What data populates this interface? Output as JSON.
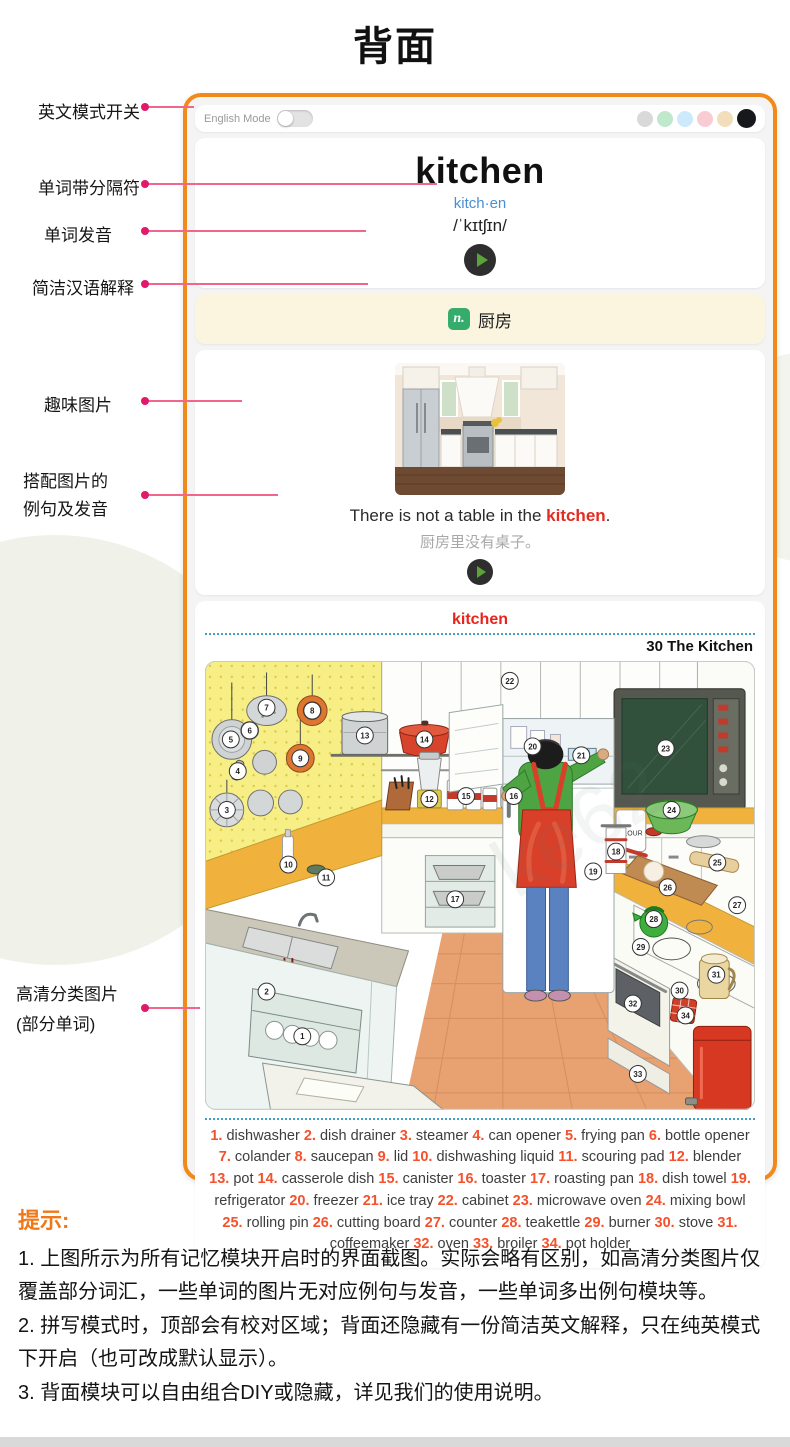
{
  "page": {
    "title": "背面"
  },
  "annotations": {
    "english_mode": "英文模式开关",
    "separator": "单词带分隔符",
    "pronunciation": "单词发音",
    "chinese_def": "简洁汉语解释",
    "fun_picture": "趣味图片",
    "example_l1": "搭配图片的",
    "example_l2": "例句及发音",
    "hd_l1": "高清分类图片",
    "hd_l2": "(部分单词)"
  },
  "card": {
    "topbar": {
      "english_mode_label": "English Mode",
      "theme_dots": [
        "#d9d9d9",
        "#bfe8cd",
        "#cdeafc",
        "#f9ccd4",
        "#f2debb",
        "#17181c"
      ]
    },
    "word": {
      "headword": "kitchen",
      "syllables": "kitch·en",
      "phonetic": "/ˈkɪtʃɪn/"
    },
    "definition": {
      "pos": "n.",
      "text": "厨房"
    },
    "example": {
      "sentence_prefix": "There is not a table in the ",
      "keyword": "kitchen",
      "suffix": ".",
      "translation": "厨房里没有桌子。"
    },
    "category": {
      "keyword": "kitchen",
      "lesson_title": "30 The Kitchen"
    }
  },
  "word_list": [
    {
      "n": "1.",
      "term": "dishwasher"
    },
    {
      "n": "2.",
      "term": "dish drainer"
    },
    {
      "n": "3.",
      "term": "steamer"
    },
    {
      "n": "4.",
      "term": "can opener"
    },
    {
      "n": "5.",
      "term": "frying pan"
    },
    {
      "n": "6.",
      "term": "bottle opener"
    },
    {
      "n": "7.",
      "term": "colander"
    },
    {
      "n": "8.",
      "term": "saucepan"
    },
    {
      "n": "9.",
      "term": "lid"
    },
    {
      "n": "10.",
      "term": "dishwashing liquid"
    },
    {
      "n": "11.",
      "term": "scouring pad"
    },
    {
      "n": "12.",
      "term": "blender"
    },
    {
      "n": "13.",
      "term": "pot"
    },
    {
      "n": "14.",
      "term": "casserole dish"
    },
    {
      "n": "15.",
      "term": "canister"
    },
    {
      "n": "16.",
      "term": "toaster"
    },
    {
      "n": "17.",
      "term": "roasting pan"
    },
    {
      "n": "18.",
      "term": "dish towel"
    },
    {
      "n": "19.",
      "term": "refrigerator"
    },
    {
      "n": "20.",
      "term": "freezer"
    },
    {
      "n": "21.",
      "term": "ice tray"
    },
    {
      "n": "22.",
      "term": "cabinet"
    },
    {
      "n": "23.",
      "term": "microwave oven"
    },
    {
      "n": "24.",
      "term": "mixing bowl"
    },
    {
      "n": "25.",
      "term": "rolling pin"
    },
    {
      "n": "26.",
      "term": "cutting board"
    },
    {
      "n": "27.",
      "term": "counter"
    },
    {
      "n": "28.",
      "term": "teakettle"
    },
    {
      "n": "29.",
      "term": "burner"
    },
    {
      "n": "30.",
      "term": "stove"
    },
    {
      "n": "31.",
      "term": "coffeemaker"
    },
    {
      "n": "32.",
      "term": "oven"
    },
    {
      "n": "33.",
      "term": "broiler"
    },
    {
      "n": "34.",
      "term": "pot holder"
    }
  ],
  "illustration": {
    "flour_label": "FLOUR",
    "watermark": "ke62",
    "badges": [
      {
        "n": "1",
        "x": 98,
        "y": 378
      },
      {
        "n": "2",
        "x": 62,
        "y": 333
      },
      {
        "n": "3",
        "x": 22,
        "y": 150
      },
      {
        "n": "4",
        "x": 33,
        "y": 111
      },
      {
        "n": "5",
        "x": 26,
        "y": 79
      },
      {
        "n": "6",
        "x": 45,
        "y": 70
      },
      {
        "n": "7",
        "x": 62,
        "y": 47
      },
      {
        "n": "8",
        "x": 108,
        "y": 50
      },
      {
        "n": "9",
        "x": 96,
        "y": 98
      },
      {
        "n": "10",
        "x": 84,
        "y": 205
      },
      {
        "n": "11",
        "x": 122,
        "y": 218
      },
      {
        "n": "12",
        "x": 226,
        "y": 139
      },
      {
        "n": "13",
        "x": 161,
        "y": 75
      },
      {
        "n": "14",
        "x": 221,
        "y": 79
      },
      {
        "n": "15",
        "x": 263,
        "y": 136
      },
      {
        "n": "16",
        "x": 311,
        "y": 136
      },
      {
        "n": "17",
        "x": 252,
        "y": 240
      },
      {
        "n": "18",
        "x": 414,
        "y": 192
      },
      {
        "n": "19",
        "x": 391,
        "y": 212
      },
      {
        "n": "20",
        "x": 330,
        "y": 86
      },
      {
        "n": "21",
        "x": 379,
        "y": 95
      },
      {
        "n": "22",
        "x": 307,
        "y": 20
      },
      {
        "n": "23",
        "x": 464,
        "y": 88
      },
      {
        "n": "24",
        "x": 470,
        "y": 150
      },
      {
        "n": "25",
        "x": 516,
        "y": 203
      },
      {
        "n": "26",
        "x": 466,
        "y": 228
      },
      {
        "n": "27",
        "x": 536,
        "y": 246
      },
      {
        "n": "28",
        "x": 452,
        "y": 260
      },
      {
        "n": "29",
        "x": 439,
        "y": 288
      },
      {
        "n": "30",
        "x": 478,
        "y": 332
      },
      {
        "n": "31",
        "x": 515,
        "y": 316
      },
      {
        "n": "32",
        "x": 431,
        "y": 345
      },
      {
        "n": "33",
        "x": 436,
        "y": 416
      },
      {
        "n": "34",
        "x": 484,
        "y": 357
      }
    ]
  },
  "tips": {
    "heading": "提示:",
    "items": [
      "1. 上图所示为所有记忆模块开启时的界面截图。实际会略有区别，如高清分类图片仅覆盖部分词汇，一些单词的图片无对应例句与发音，一些单词多出例句模块等。",
      "2. 拼写模式时，顶部会有校对区域；背面还隐藏有一份简洁英文解释，只在纯英模式下开启（也可改成默认显示）。",
      "3. 背面模块可以自由组合DIY或隐藏，详见我们的使用说明。"
    ]
  }
}
